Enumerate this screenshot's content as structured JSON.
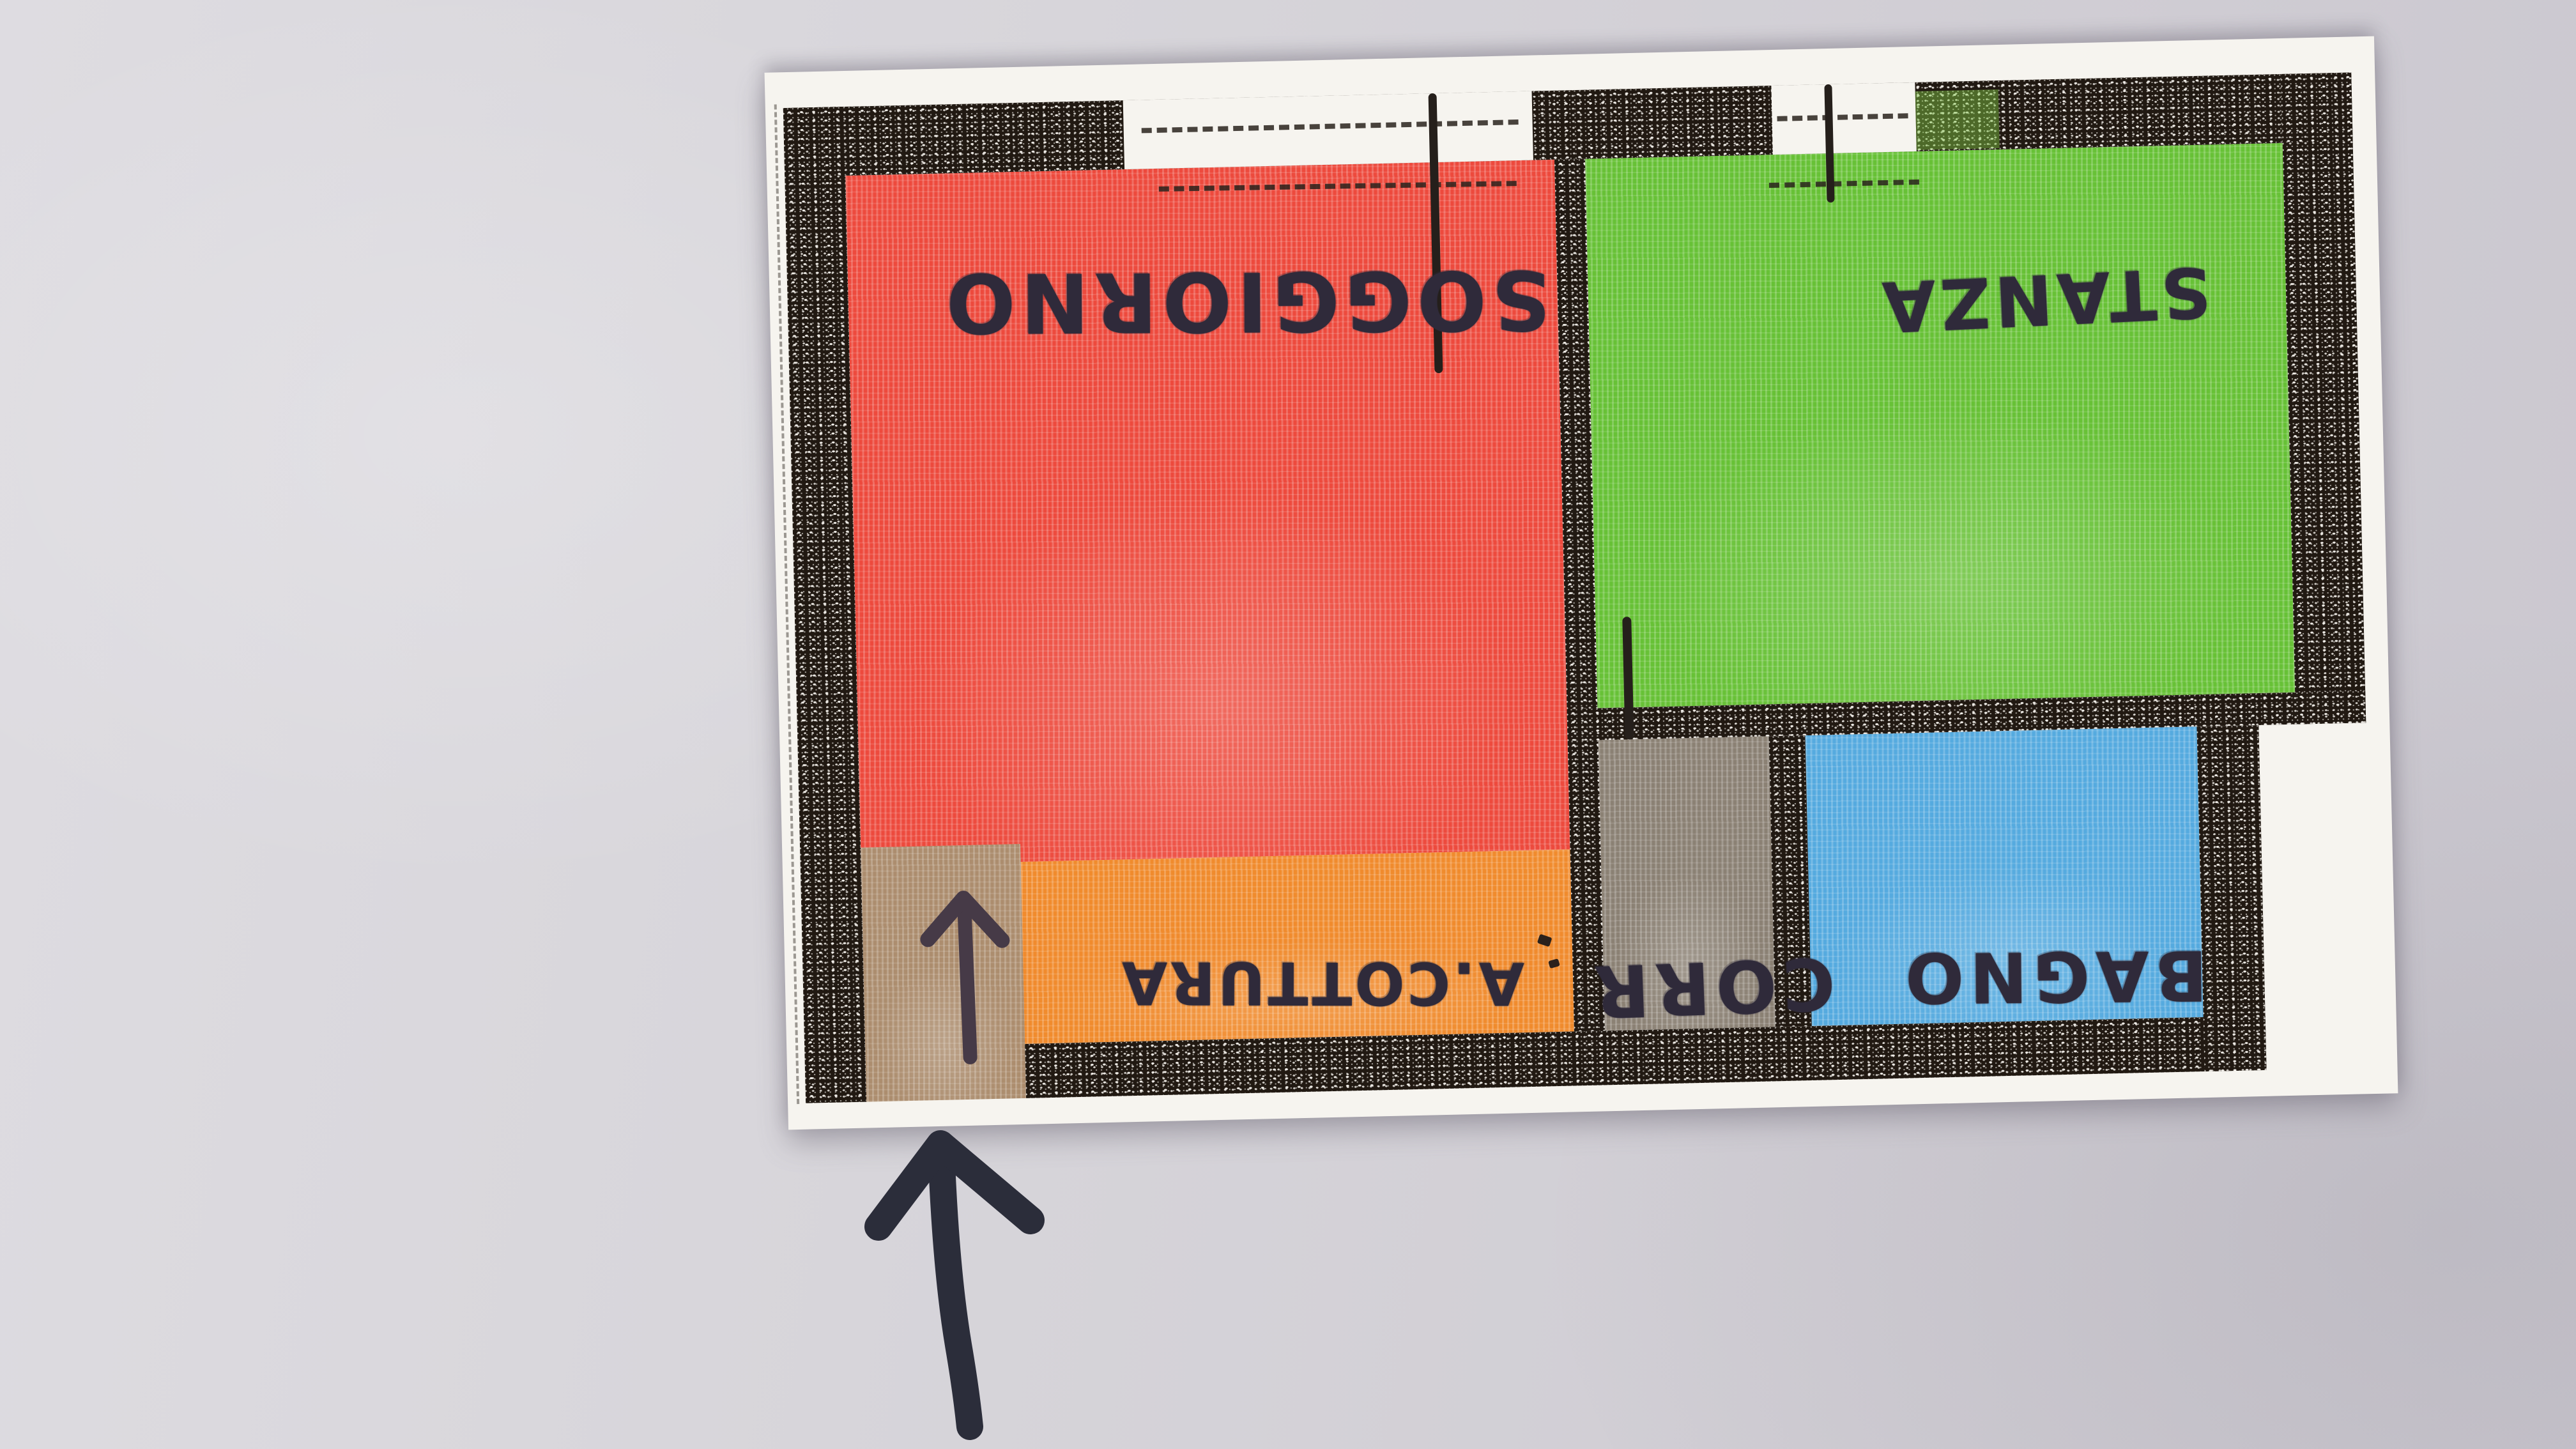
{
  "scene": {
    "description": "Photo of a hand-drawn apartment floor plan, colored with crayons, photographed upside-down on a gray surface",
    "orientation_note": "room labels appear rotated 180 degrees"
  },
  "floor_plan": {
    "rooms": [
      {
        "id": "soggiorno",
        "label": "SOGGIORNO",
        "color": "#ed4a3d"
      },
      {
        "id": "stanza",
        "label": "STANZA",
        "color": "#67c136"
      },
      {
        "id": "cottura",
        "label": "A.COTTURA",
        "color": "#f08b2d"
      },
      {
        "id": "corridoio",
        "label": "CORR",
        "color": "#8b8174"
      },
      {
        "id": "bagno",
        "label": "BAGNO",
        "color": "#55aadf"
      },
      {
        "id": "ingresso",
        "label": "",
        "color": "#ac8d6e"
      }
    ],
    "icons": [
      {
        "name": "entrance-arrow-icon",
        "glyph": "up-arrow",
        "color": "#463a47"
      },
      {
        "name": "direction-arrow-icon",
        "glyph": "up-arrow",
        "color": "#2b2d3a"
      }
    ],
    "colors": {
      "wall_ink": "#211912",
      "paper": "#f6f4ef",
      "background_surface": "#d7d5da",
      "marker": "#2f2a3a"
    }
  }
}
